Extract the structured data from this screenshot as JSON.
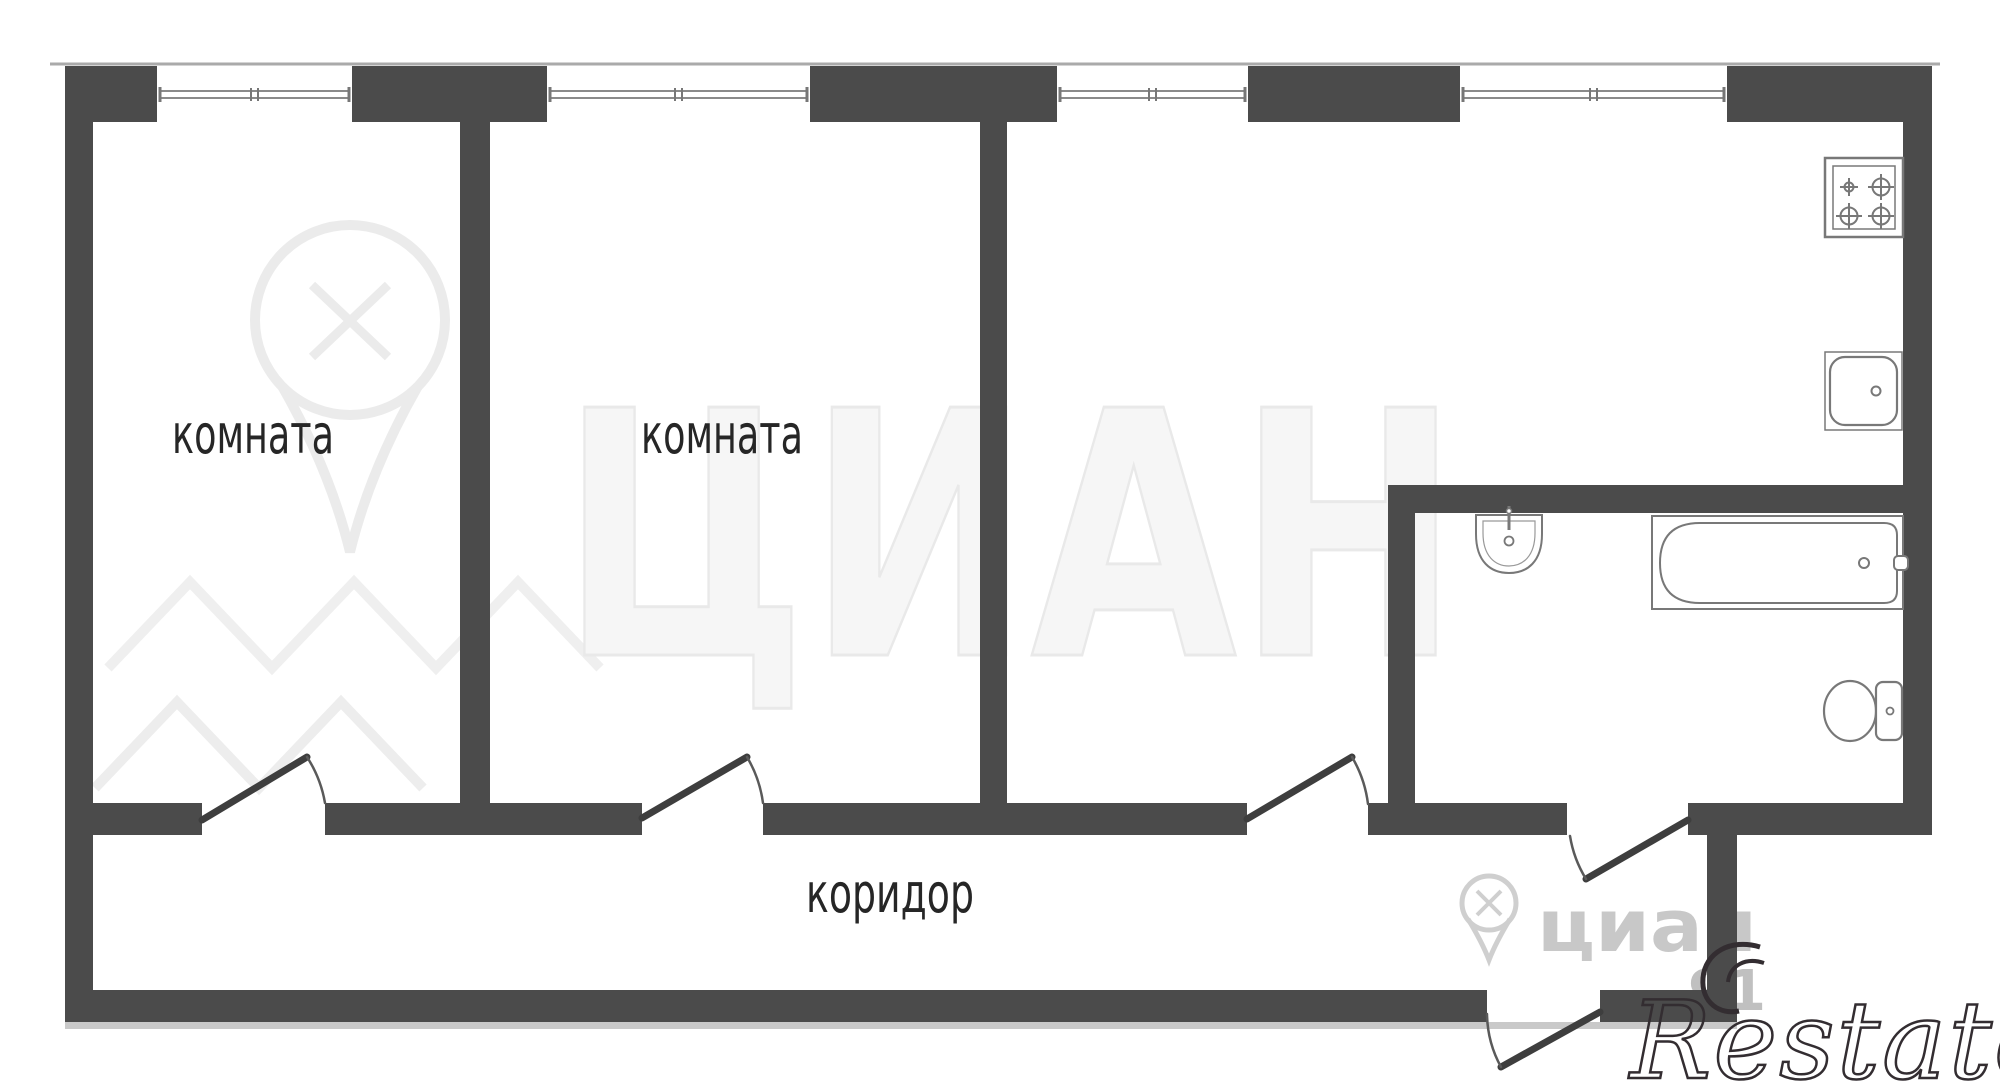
{
  "page": {
    "type": "apartment-floor-plan"
  },
  "colors": {
    "background": "#ffffff",
    "wall": "#4b4b4b",
    "wall_shadow": "#c9c9c9",
    "outer_edge_line": "#aaaaaa",
    "window_frame": "#8a8a8a",
    "door_leaf": "#3e3e3e",
    "door_arc": "#5a5a5a",
    "fixture_outline": "#787878",
    "label_text": "#262626",
    "watermark_faint": "#ededed",
    "watermark_gray": "#c8c8c8",
    "logo_outline": "#332d31"
  },
  "rooms": [
    {
      "name": "room-1",
      "label": "комната"
    },
    {
      "name": "room-2",
      "label": "комната"
    },
    {
      "name": "corridor",
      "label": "коридор"
    },
    {
      "name": "kitchen",
      "label": ""
    },
    {
      "name": "bathroom",
      "label": ""
    }
  ],
  "watermarks": {
    "brand_large": "ЦИАН",
    "brand_small": "циан",
    "number_fragment": "91",
    "agency_logo": "Restate"
  }
}
